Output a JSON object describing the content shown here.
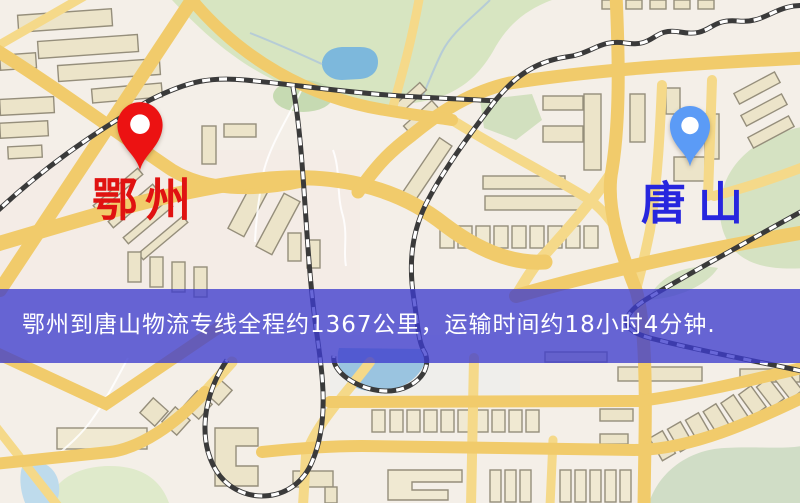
{
  "map": {
    "markers": [
      {
        "id": "origin",
        "label": "鄂州",
        "pin_color": "#ec1212",
        "label_color": "#e01211"
      },
      {
        "id": "destination",
        "label": "唐山",
        "pin_color": "#5b9bf6",
        "label_color": "#2726de"
      }
    ]
  },
  "banner": {
    "text": "鄂州到唐山物流专线全程约1367公里，运输时间约18小时4分钟.",
    "background": "#3e3ccd",
    "text_color": "#ffffff"
  },
  "route": {
    "origin": "鄂州",
    "destination": "唐山",
    "distance": "约1367公里",
    "duration": "约18小时4分钟"
  }
}
